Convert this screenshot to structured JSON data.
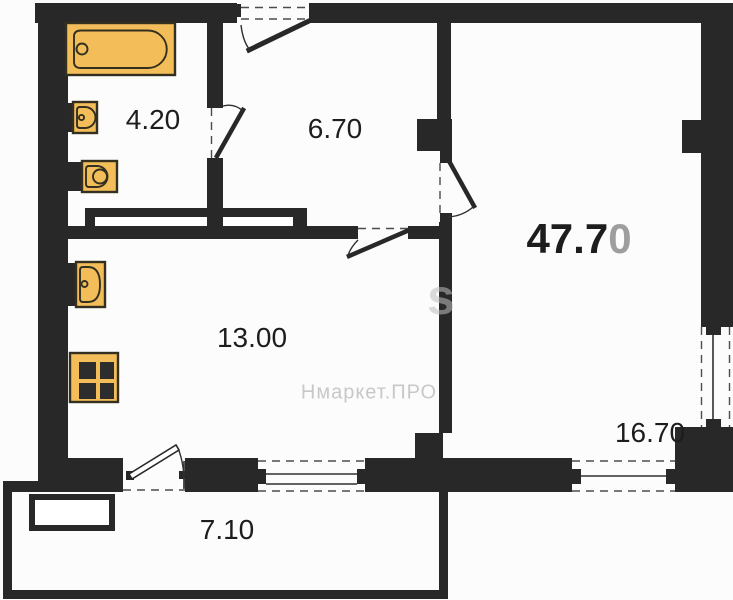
{
  "title": "Apartment floor plan",
  "colors": {
    "wall": "#282828",
    "fixture_fill": "#f3bd5a",
    "fixture_stroke": "#33301f",
    "label": "#1d1d1d",
    "muted_digit": "#9e9e9e",
    "watermark": "#c8c8c8",
    "background": "#fcfcfc"
  },
  "total_area": {
    "main": "47.7",
    "suffix": "0"
  },
  "rooms": [
    {
      "id": "bathroom",
      "area": "4.20"
    },
    {
      "id": "hallway",
      "area": "6.70"
    },
    {
      "id": "kitchen",
      "area": "13.00"
    },
    {
      "id": "living-room",
      "area": "16.70"
    },
    {
      "id": "balcony",
      "area": "7.10"
    }
  ],
  "watermark": {
    "text": "Нмаркет.ПРО",
    "large_letter": "s"
  },
  "fixtures": [
    "bathtub-icon",
    "bathroom-sink-icon",
    "toilet-icon",
    "kitchen-sink-icon",
    "stove-icon"
  ]
}
